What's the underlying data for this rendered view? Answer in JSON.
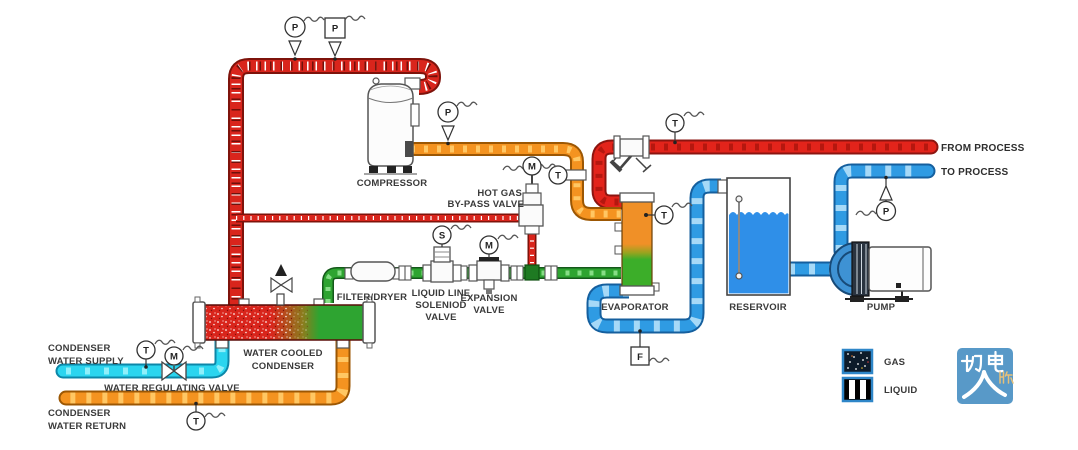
{
  "labels": {
    "compressor": "COMPRESSOR",
    "hot_gas_line1": "HOT GAS",
    "hot_gas_line2": "BY-PASS VALVE",
    "filter_dryer": "FILTER/DRYER",
    "solenoid_line1": "LIQUID LINE",
    "solenoid_line2": "SOLENIOD",
    "solenoid_line3": "VALVE",
    "expansion_line1": "EXPANSION",
    "expansion_line2": "VALVE",
    "evaporator": "EVAPORATOR",
    "reservoir": "RESERVOIR",
    "pump": "PUMP",
    "from_process": "FROM PROCESS",
    "to_process": "TO PROCESS",
    "condenser_line1": "WATER COOLED",
    "condenser_line2": "CONDENSER",
    "supply_line1": "CONDENSER",
    "supply_line2": "WATER SUPPLY",
    "regulating_valve": "WATER REGULATING VALVE",
    "return_line1": "CONDENSER",
    "return_line2": "WATER RETURN"
  },
  "instruments": {
    "discharge_p_circle": "P",
    "discharge_p_square": "P",
    "suction_p": "P",
    "suction_t": "T",
    "bypass_m": "M",
    "process_in_t": "T",
    "evaporator_t": "T",
    "process_out_p": "P",
    "solenoid_s": "S",
    "expansion_m": "M",
    "supply_t": "T",
    "regulating_m": "M",
    "return_t": "T",
    "flow_f": "F"
  },
  "legend": {
    "gas": "GAS",
    "liquid": "LIQUID"
  },
  "logo": {
    "characters": "机电人脉",
    "background": "#5899C8"
  },
  "colors": {
    "refrigerant_gas_pipe": "#D9251C",
    "hot_water_pipe": "#E3241B",
    "chilled_water_pipe": "#2F9BE3",
    "condenser_supply_pipe": "#2BD5EF",
    "condenser_return_pipe": "#F49320",
    "suction_gas_pipe": "#F49320",
    "liquid_refrigerant_pipe": "#2EA431",
    "evaporator_top_fill": "#F09027",
    "evaporator_bottom_fill": "#3CAE29",
    "reservoir_water": "#2F8FE8",
    "legend_border": "#2E86C8"
  }
}
